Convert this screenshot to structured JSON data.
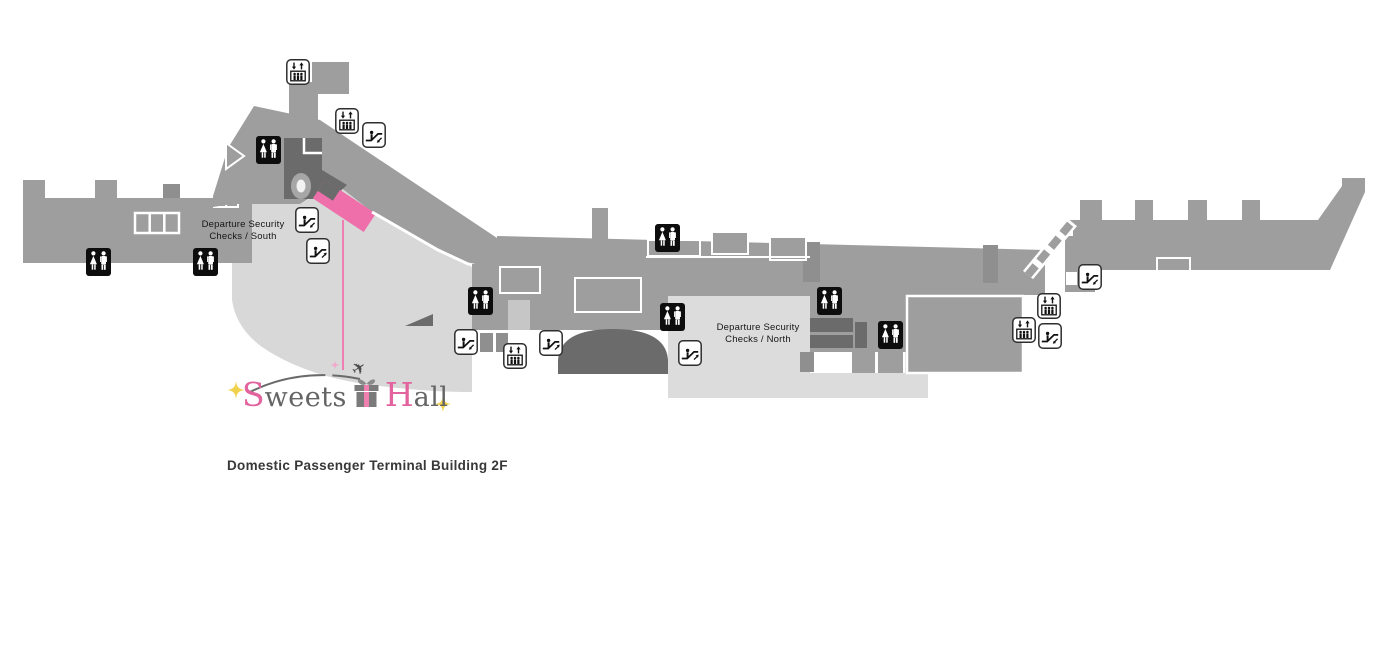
{
  "map": {
    "security_south": {
      "line1": "Departure Security",
      "line2": "Checks / South"
    },
    "security_north": {
      "line1": "Departure Security",
      "line2": "Checks / North"
    },
    "colors": {
      "terminal_gray": "#9e9e9e",
      "dark_gray": "#6b6b6b",
      "concourse_light_gray": "#d8d8d8",
      "north_light_gray": "#dcdcdc",
      "highlight_pink": "#ee6fa9",
      "leader_line_pink": "#ef7fb3"
    },
    "icons": [
      {
        "type": "elevator",
        "x": 286,
        "y": 59
      },
      {
        "type": "elevator",
        "x": 335,
        "y": 108
      },
      {
        "type": "escalator-down",
        "x": 362,
        "y": 122
      },
      {
        "type": "restroom",
        "x": 256,
        "y": 136
      },
      {
        "type": "escalator-down",
        "x": 295,
        "y": 207
      },
      {
        "type": "escalator-up",
        "x": 306,
        "y": 238
      },
      {
        "type": "restroom",
        "x": 86,
        "y": 248
      },
      {
        "type": "restroom",
        "x": 193,
        "y": 248
      },
      {
        "type": "restroom",
        "x": 655,
        "y": 224
      },
      {
        "type": "restroom",
        "x": 468,
        "y": 287
      },
      {
        "type": "restroom",
        "x": 660,
        "y": 303
      },
      {
        "type": "restroom",
        "x": 817,
        "y": 287
      },
      {
        "type": "restroom",
        "x": 878,
        "y": 321
      },
      {
        "type": "escalator-down",
        "x": 454,
        "y": 329
      },
      {
        "type": "elevator",
        "x": 503,
        "y": 343
      },
      {
        "type": "escalator-up",
        "x": 539,
        "y": 330
      },
      {
        "type": "escalator-up",
        "x": 678,
        "y": 340
      },
      {
        "type": "escalator-down",
        "x": 1078,
        "y": 264
      },
      {
        "type": "elevator",
        "x": 1037,
        "y": 293
      },
      {
        "type": "elevator",
        "x": 1012,
        "y": 317
      },
      {
        "type": "escalator-down",
        "x": 1038,
        "y": 323
      }
    ]
  },
  "logo": {
    "word1_initial": "S",
    "word1_rest": "weets",
    "word2_initial": "H",
    "word2_rest": "all",
    "pink": "#e2639e",
    "gray": "#646464",
    "sparkle_yellow": "#f0d24f",
    "sparkle_pink": "#f2a7cb"
  },
  "caption": "Domestic Passenger Terminal Building 2F"
}
